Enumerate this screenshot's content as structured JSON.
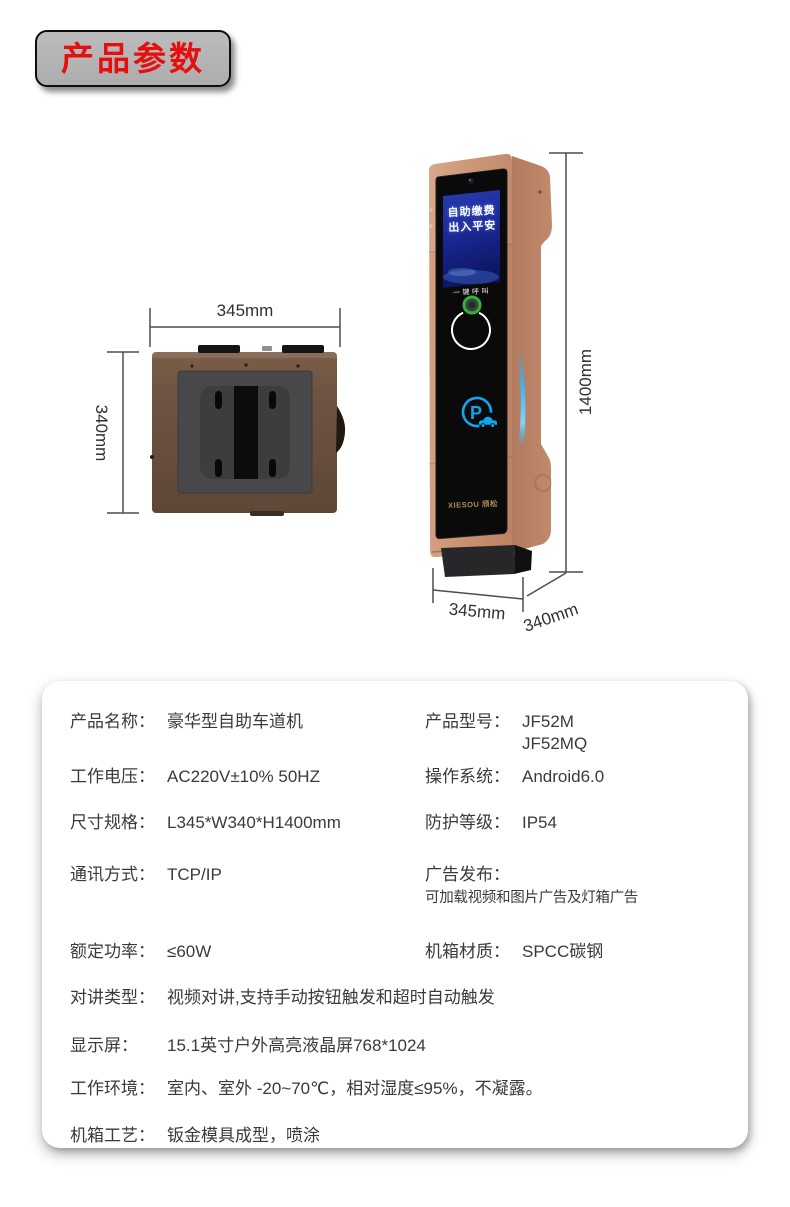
{
  "header": {
    "badge": "产品参数"
  },
  "figure": {
    "top_view": {
      "width_label": "345mm",
      "depth_label": "340mm"
    },
    "front_view": {
      "height_label": "1400mm",
      "width_label": "345mm",
      "depth_label": "340mm",
      "screen_line1": "自助缴费",
      "screen_line2": "出入平安",
      "call_label": "一键呼叫",
      "parking_letter": "P",
      "brand": "XIESOU 颀松"
    },
    "colors": {
      "copper": "#c68f73",
      "accent_cyan": "#0fa6ee",
      "button_green": "#2fb13d",
      "brand_gold": "#ad8a50",
      "badge_red": "#e60e0e"
    }
  },
  "specs": {
    "pair_rows": [
      {
        "l_label": "产品名称：",
        "l_value": "豪华型自助车道机",
        "r_label": "产品型号：",
        "r_value": "JF52M",
        "r_value2": "JF52MQ"
      },
      {
        "l_label": "工作电压：",
        "l_value": "AC220V±10% 50HZ",
        "r_label": "操作系统：",
        "r_value": "Android6.0"
      },
      {
        "l_label": "尺寸规格：",
        "l_value": "L345*W340*H1400mm",
        "r_label": "防护等级：",
        "r_value": "IP54"
      },
      {
        "l_label": "通讯方式：",
        "l_value": "TCP/IP",
        "r_label": "广告发布：",
        "r_value": "可加载视频和图片广告及灯箱广告"
      },
      {
        "l_label": "额定功率：",
        "l_value": "≤60W",
        "r_label": "机箱材质：",
        "r_value": "SPCC碳钢"
      }
    ],
    "full_rows": [
      {
        "label": "对讲类型：",
        "value": "视频对讲,支持手动按钮触发和超时自动触发"
      },
      {
        "label": "显示屏：",
        "value": "15.1英寸户外高亮液晶屏768*1024"
      },
      {
        "label": "工作环境：",
        "value": "室内、室外 -20~70℃，相对湿度≤95%，不凝露。"
      },
      {
        "label": "机箱工艺：",
        "value": "钣金模具成型，喷涂"
      }
    ]
  }
}
